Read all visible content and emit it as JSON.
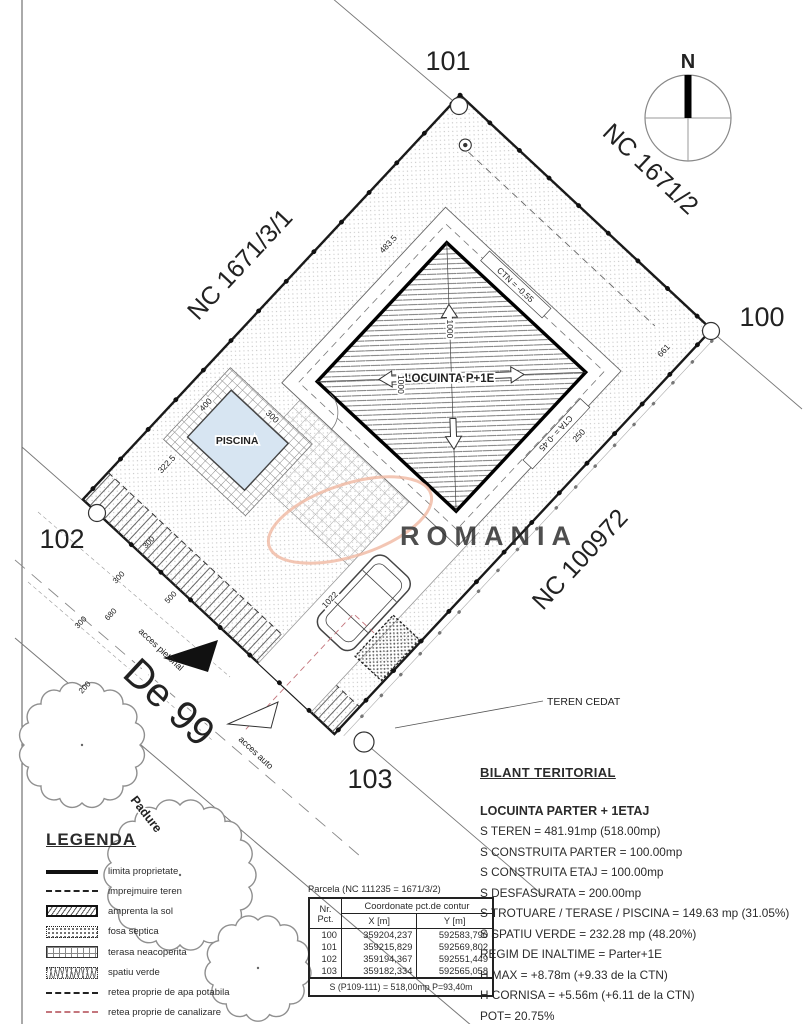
{
  "plan": {
    "corners": {
      "c100": "100",
      "c101": "101",
      "c102": "102",
      "c103": "103"
    },
    "neighbors": {
      "ne": "NC 1671/2",
      "nw": "NC 1671/3/1",
      "se": "NC 100972"
    },
    "road_name": "De 99",
    "forest_label": "Padure",
    "building_label": "LOCUINTA P+1E",
    "pool_label": "PISCINA",
    "teren_cedat_label": "TEREN CEDAT",
    "access_pedestrian": "acces pietonal",
    "access_auto": "acces auto",
    "compass_north": "N",
    "level_ctn": "CTN = -0.55",
    "level_cta": "CTA = -0.45",
    "dims": {
      "nw_offset": "483.5",
      "ne_offset": "661",
      "bldg_diag_1": "1000",
      "bldg_diag_2": "1000",
      "drive_len": "1022",
      "nw_lower": "322.5",
      "pool_w": "400",
      "pool_l": "300",
      "se_offset": "250",
      "road_1": "300",
      "road_2": "500",
      "road_3": "300",
      "road_4": "680",
      "road_5": "300",
      "road_6": "200"
    }
  },
  "watermark": {
    "text": "ROMANIA",
    "color": "#f2b7a0"
  },
  "bilant": {
    "title": "BILANT TERITORIAL",
    "subtitle": "LOCUINTA PARTER + 1ETAJ",
    "lines": [
      "S TEREN = 481.91mp (518.00mp)",
      "S CONSTRUITA PARTER = 100.00mp",
      "S CONSTRUITA ETAJ = 100.00mp",
      "S DESFASURATA = 200.00mp",
      "S TROTUARE / TERASE / PISCINA = 149.63 mp (31.05%)",
      "S SPATIU VERDE = 232.28 mp (48.20%)",
      "REGIM DE INALTIME = Parter+1E",
      "H MAX = +8.78m (+9.33 de la CTN)",
      "H CORNISA = +5.56m (+6.11 de la CTN)",
      "POT= 20.75%",
      "CUT= 0.39"
    ]
  },
  "legend": {
    "title": "LEGENDA",
    "items": [
      {
        "label": "limita proprietate"
      },
      {
        "label": "imprejmuire teren"
      },
      {
        "label": "amprenta la sol"
      },
      {
        "label": "fosa septica"
      },
      {
        "label": "terasa neacoperita"
      },
      {
        "label": "spatiu verde"
      },
      {
        "label": "retea proprie de apa potabila"
      },
      {
        "label": "retea proprie de canalizare"
      }
    ]
  },
  "table": {
    "title": "Parcela (NC 111235 = 1671/3/2)",
    "header_nr_line1": "Nr.",
    "header_nr_line2": "Pct.",
    "header_group": "Coordonate pct.de contur",
    "header_x": "X [m]",
    "header_y": "Y [m]",
    "rows": [
      {
        "nr": "100",
        "x": "359204,237",
        "y": "592583,790"
      },
      {
        "nr": "101",
        "x": "359215,829",
        "y": "592569,802"
      },
      {
        "nr": "102",
        "x": "359194,367",
        "y": "592551,449"
      },
      {
        "nr": "103",
        "x": "359182,334",
        "y": "592565,058"
      }
    ],
    "footer": "S (P109-111) = 518,00mp P=93,40m"
  }
}
